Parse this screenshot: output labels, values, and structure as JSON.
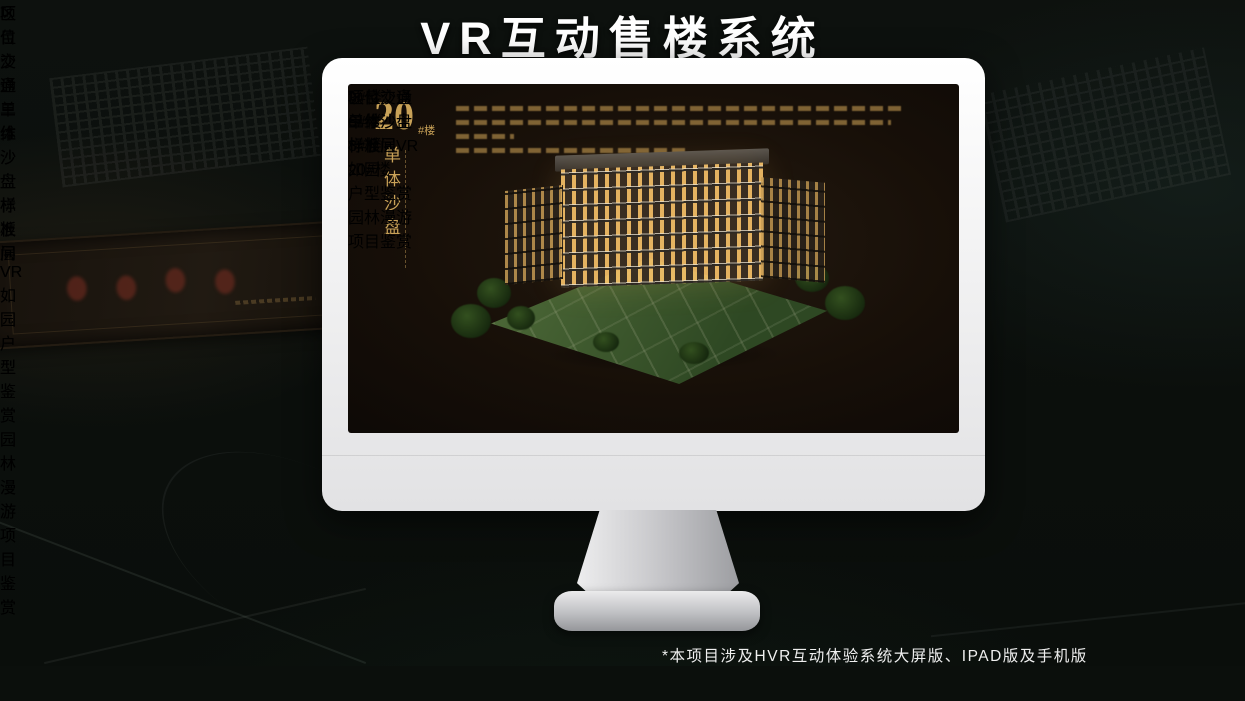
{
  "page": {
    "title": "VR互动售楼系统",
    "footnote": "*本项目涉及HVR互动体验系统大屏版、IPAD版及手机版"
  },
  "colors": {
    "gold": "#C9A258",
    "gold_bright": "#ECC97E",
    "nav_background": "#0C0906",
    "screen_background": "#170F08"
  },
  "monitor": {
    "heading": {
      "number": "20",
      "unit": "#楼",
      "vertical_title": "单体沙盘"
    },
    "tabs": [
      {
        "label": "项目沙盘",
        "active": false
      },
      {
        "label": "单体沙盘",
        "active": true
      },
      {
        "label": "标准层",
        "active": false
      }
    ],
    "building_buttons": [
      {
        "label": "3#楼",
        "active": false
      },
      {
        "label": "6#楼",
        "active": false
      },
      {
        "label": "8#楼",
        "active": false
      },
      {
        "label": "20#楼",
        "active": true
      }
    ],
    "nav": {
      "logo": "如园",
      "items": [
        {
          "label": "区位交通",
          "active": false
        },
        {
          "label": "三维沙盘",
          "active": true
        },
        {
          "label": "样板间VR",
          "active": false
        },
        {
          "label": "户型鉴赏",
          "active": false
        },
        {
          "label": "园林漫游",
          "active": false
        },
        {
          "label": "项目鉴赏",
          "active": false
        }
      ]
    }
  },
  "tablet": {
    "tabs": [
      {
        "label": "项目沙盘",
        "active": true
      },
      {
        "label": "单体沙盘",
        "active": false
      },
      {
        "label": "标准层",
        "active": false
      }
    ],
    "nav": {
      "logo": "如园",
      "items": [
        {
          "label": "区位交通",
          "active": false
        },
        {
          "label": "三维沙盘",
          "active": true
        },
        {
          "label": "样板间VR",
          "active": false
        },
        {
          "label": "户型鉴赏",
          "active": false
        },
        {
          "label": "园林漫游",
          "active": false
        },
        {
          "label": "项目鉴赏",
          "active": false
        }
      ]
    }
  },
  "phone": {
    "nav": {
      "logo": "如园",
      "items": [
        {
          "label": "区位交通",
          "active": false
        },
        {
          "label": "三维沙盘",
          "active": false
        },
        {
          "label": "样板间VR",
          "active": false
        },
        {
          "label": "户型鉴赏",
          "active": false
        },
        {
          "label": "园林漫游",
          "active": true
        },
        {
          "label": "项目鉴赏",
          "active": false
        }
      ]
    }
  }
}
